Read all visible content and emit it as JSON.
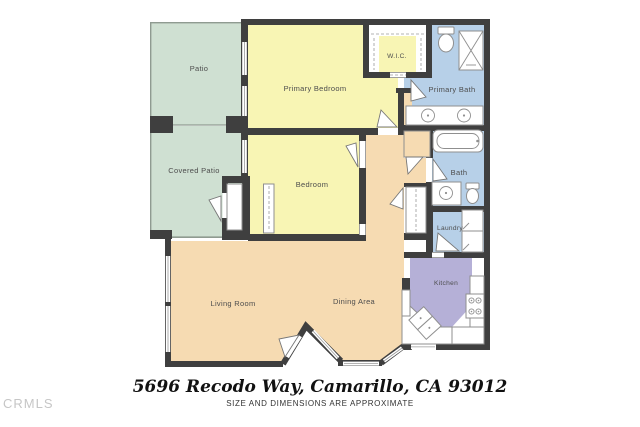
{
  "rooms": {
    "patio": {
      "label": "Patio"
    },
    "covered_patio": {
      "label": "Covered Patio"
    },
    "primary_bedroom": {
      "label": "Primary Bedroom"
    },
    "wic": {
      "label": "W.I.C."
    },
    "primary_bath": {
      "label": "Primary Bath"
    },
    "bedroom": {
      "label": "Bedroom"
    },
    "bath": {
      "label": "Bath"
    },
    "laundry": {
      "label": "Laundry"
    },
    "kitchen": {
      "label": "Kitchen"
    },
    "living_room": {
      "label": "Living Room"
    },
    "dining_area": {
      "label": "Dining Area"
    }
  },
  "footer": {
    "address": "5696 Recodo Way, Camarillo, CA 93012",
    "disclaimer": "SIZE AND DIMENSIONS ARE APPROXIMATE"
  },
  "watermark": "CRMLS",
  "colors": {
    "wall": "#3f3f3f",
    "patio": "#cfe0d2",
    "bedroom": "#f8f5b4",
    "bath": "#b7d0e8",
    "living": "#f6dbb2",
    "kitchen": "#b5b0d7",
    "outline": "#8f8f8f",
    "label": "#4d4d4d",
    "watermark": "#c6c6c6"
  }
}
